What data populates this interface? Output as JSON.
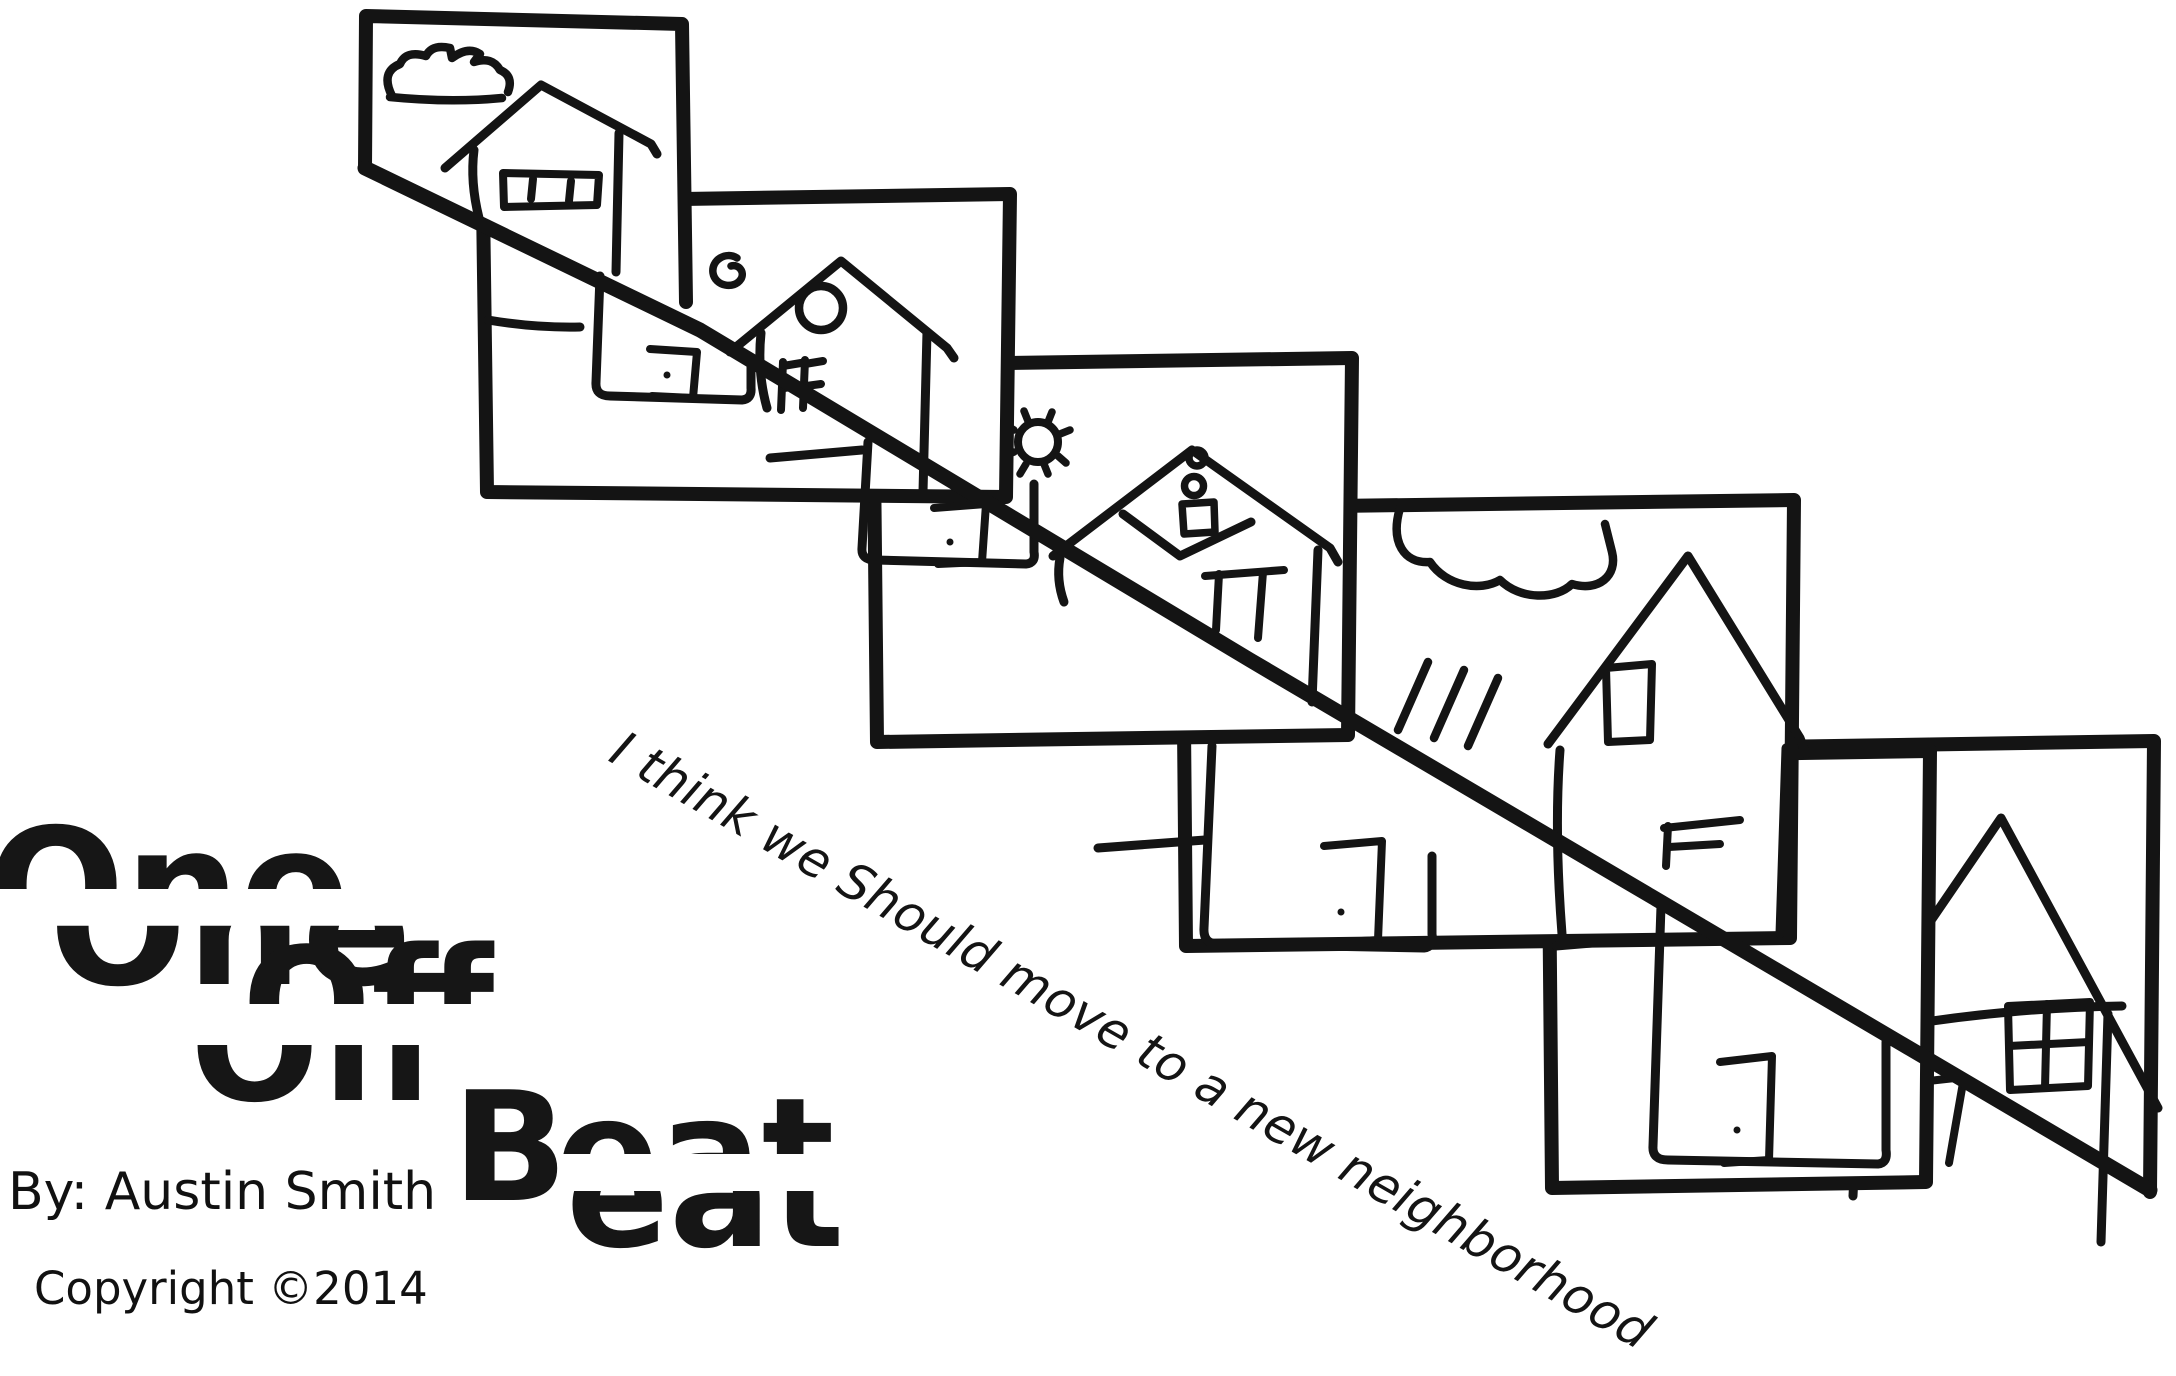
{
  "page": {
    "background_color": "#ffffff",
    "ink_color": "#141414"
  },
  "title": {
    "word1": "One",
    "word2": "Off",
    "word3_initial": "B",
    "word3_rest": "eat"
  },
  "credits": {
    "byline": "By: Austin Smith",
    "copyright": "Copyright ©2014"
  },
  "caption": {
    "text": "I think we Should move to a new neighborhood"
  },
  "scene": {
    "panel_count": 6,
    "panels": [
      {
        "label": "panel-1",
        "decoration": "cloud-icon",
        "house": "house-split-by-line"
      },
      {
        "label": "panel-2",
        "decoration": "swirl-sun-icon",
        "house": "house-round-gable-window"
      },
      {
        "label": "panel-3",
        "decoration": "gear-sun-icon",
        "house": "house-envelope-gable"
      },
      {
        "label": "panel-4",
        "decoration": "rain-cloud-icon",
        "house": "house-tall-window"
      },
      {
        "label": "panel-5",
        "decoration": "",
        "house": "house-bottom-with-door"
      },
      {
        "label": "panel-6",
        "decoration": "",
        "house": "house-four-pane-window"
      }
    ]
  }
}
